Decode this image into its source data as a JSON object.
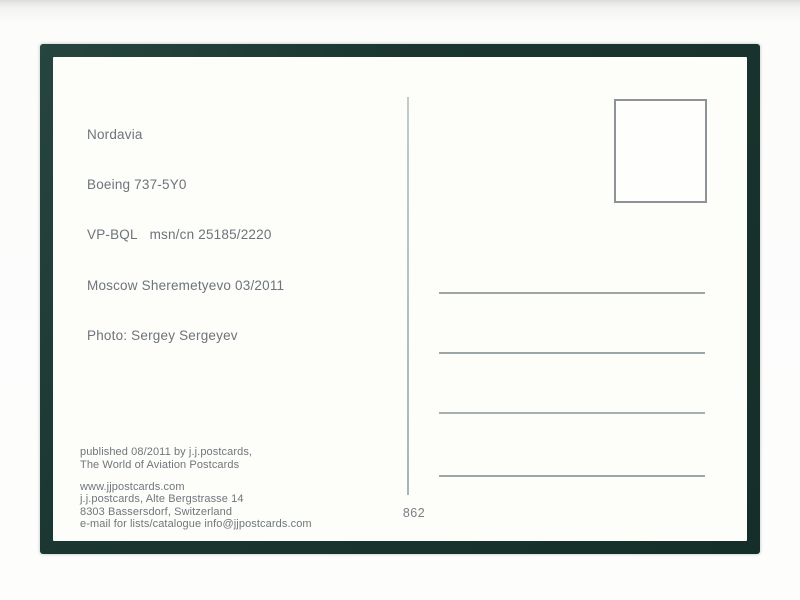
{
  "postcard": {
    "info_lines": [
      "Nordavia",
      "Boeing 737-5Y0",
      "VP-BQL   msn/cn 25185/2220",
      "Moscow Sheremetyevo 03/2011",
      "Photo: Sergey Sergeyev"
    ],
    "publisher_lines": [
      "published 08/2011 by j.j.postcards,",
      "The World of Aviation Postcards"
    ],
    "contact_lines": [
      "www.jjpostcards.com",
      "j.j.postcards, Alte Bergstrasse 14",
      "8303 Bassersdorf, Switzerland",
      "e-mail for lists/catalogue info@jjpostcards.com"
    ],
    "card_number": "862",
    "colors": {
      "frame_green": "#1b3631",
      "card_white": "#fdfdfa",
      "print_gray": "#6d747b",
      "rule_gray": "#9ea5a7"
    }
  }
}
